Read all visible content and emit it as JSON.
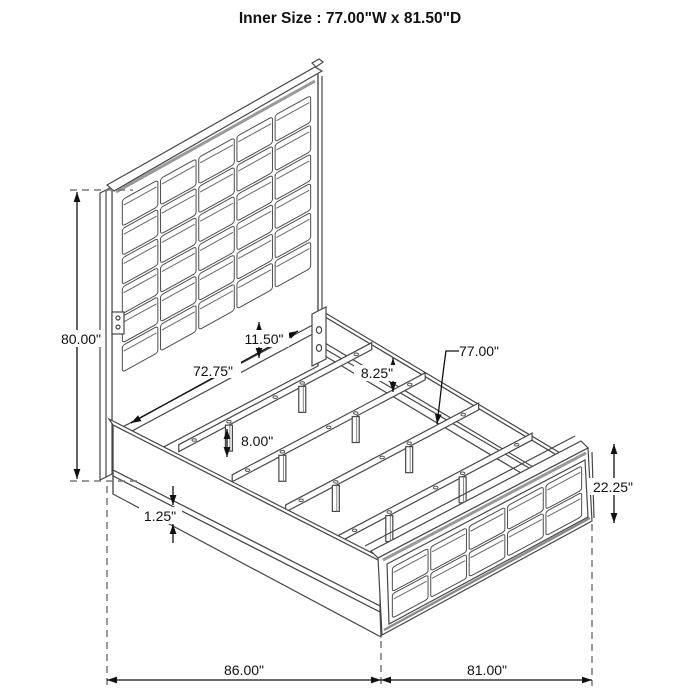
{
  "title": "Inner Size : 77.00\"W x 81.50\"D",
  "diagram": {
    "type": "isometric-line-drawing",
    "subject": "upholstered-panel-bed-frame",
    "line_color": "#474747",
    "dim_color": "#111111",
    "shade_color": "#999999",
    "headboard_grid": {
      "cols": 5,
      "rows": 6
    },
    "footboard_grid": {
      "cols": 5,
      "rows": 2
    },
    "slat_count": 4
  },
  "dimensions": {
    "headboard_height": "80.00\"",
    "panel_to_rail_gap": "11.50\"",
    "inner_frame_width": "72.75\"",
    "side_rail_height": "8.25\"",
    "slat_length": "77.00\"",
    "leg_height": "8.00\"",
    "base_trim_height": "1.25\"",
    "footboard_height": "22.25\"",
    "overall_depth": "86.00\"",
    "overall_width": "81.00\""
  }
}
